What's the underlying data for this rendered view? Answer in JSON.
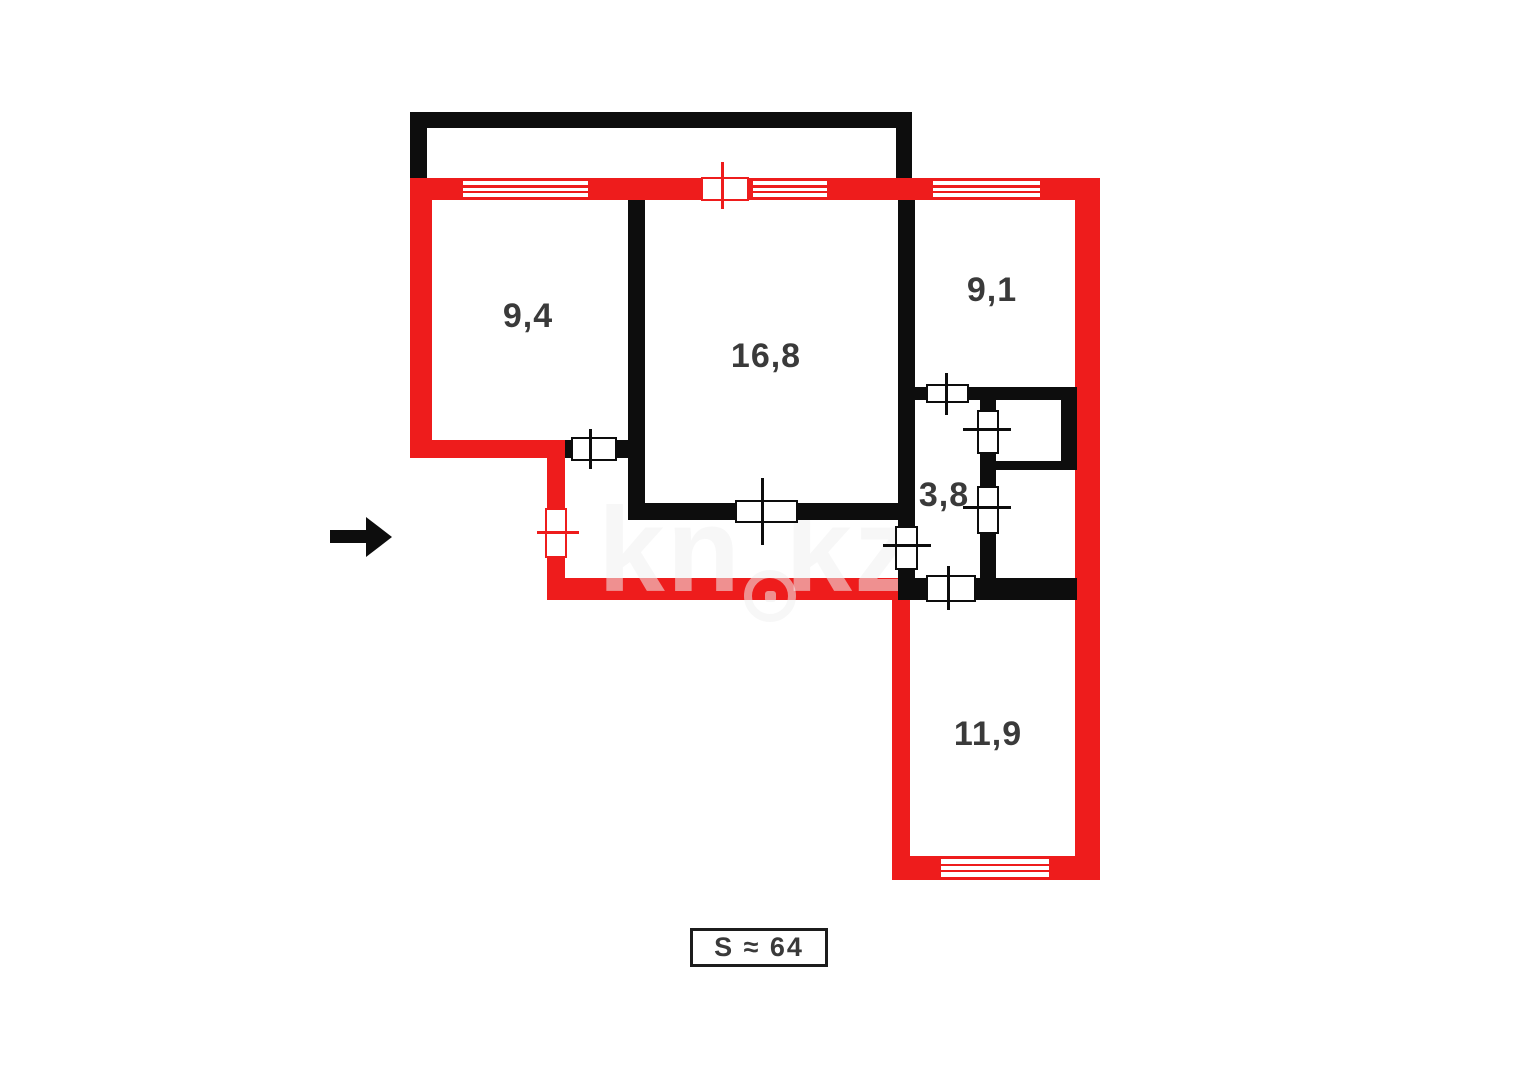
{
  "plan": {
    "rooms": [
      {
        "name": "room-top-left",
        "area": "9,4"
      },
      {
        "name": "room-living",
        "area": "16,8"
      },
      {
        "name": "room-top-right",
        "area": "9,1"
      },
      {
        "name": "corridor",
        "area": "3,8"
      },
      {
        "name": "room-bottom",
        "area": "11,9"
      }
    ],
    "total_area_label": "S ≈ 64",
    "watermark": {
      "part1": "kn",
      "part2": "kz"
    },
    "colors": {
      "exterior_wall": "#ee1c1c",
      "interior_wall": "#0d0d0d",
      "label_text": "#3a3a3a"
    }
  }
}
